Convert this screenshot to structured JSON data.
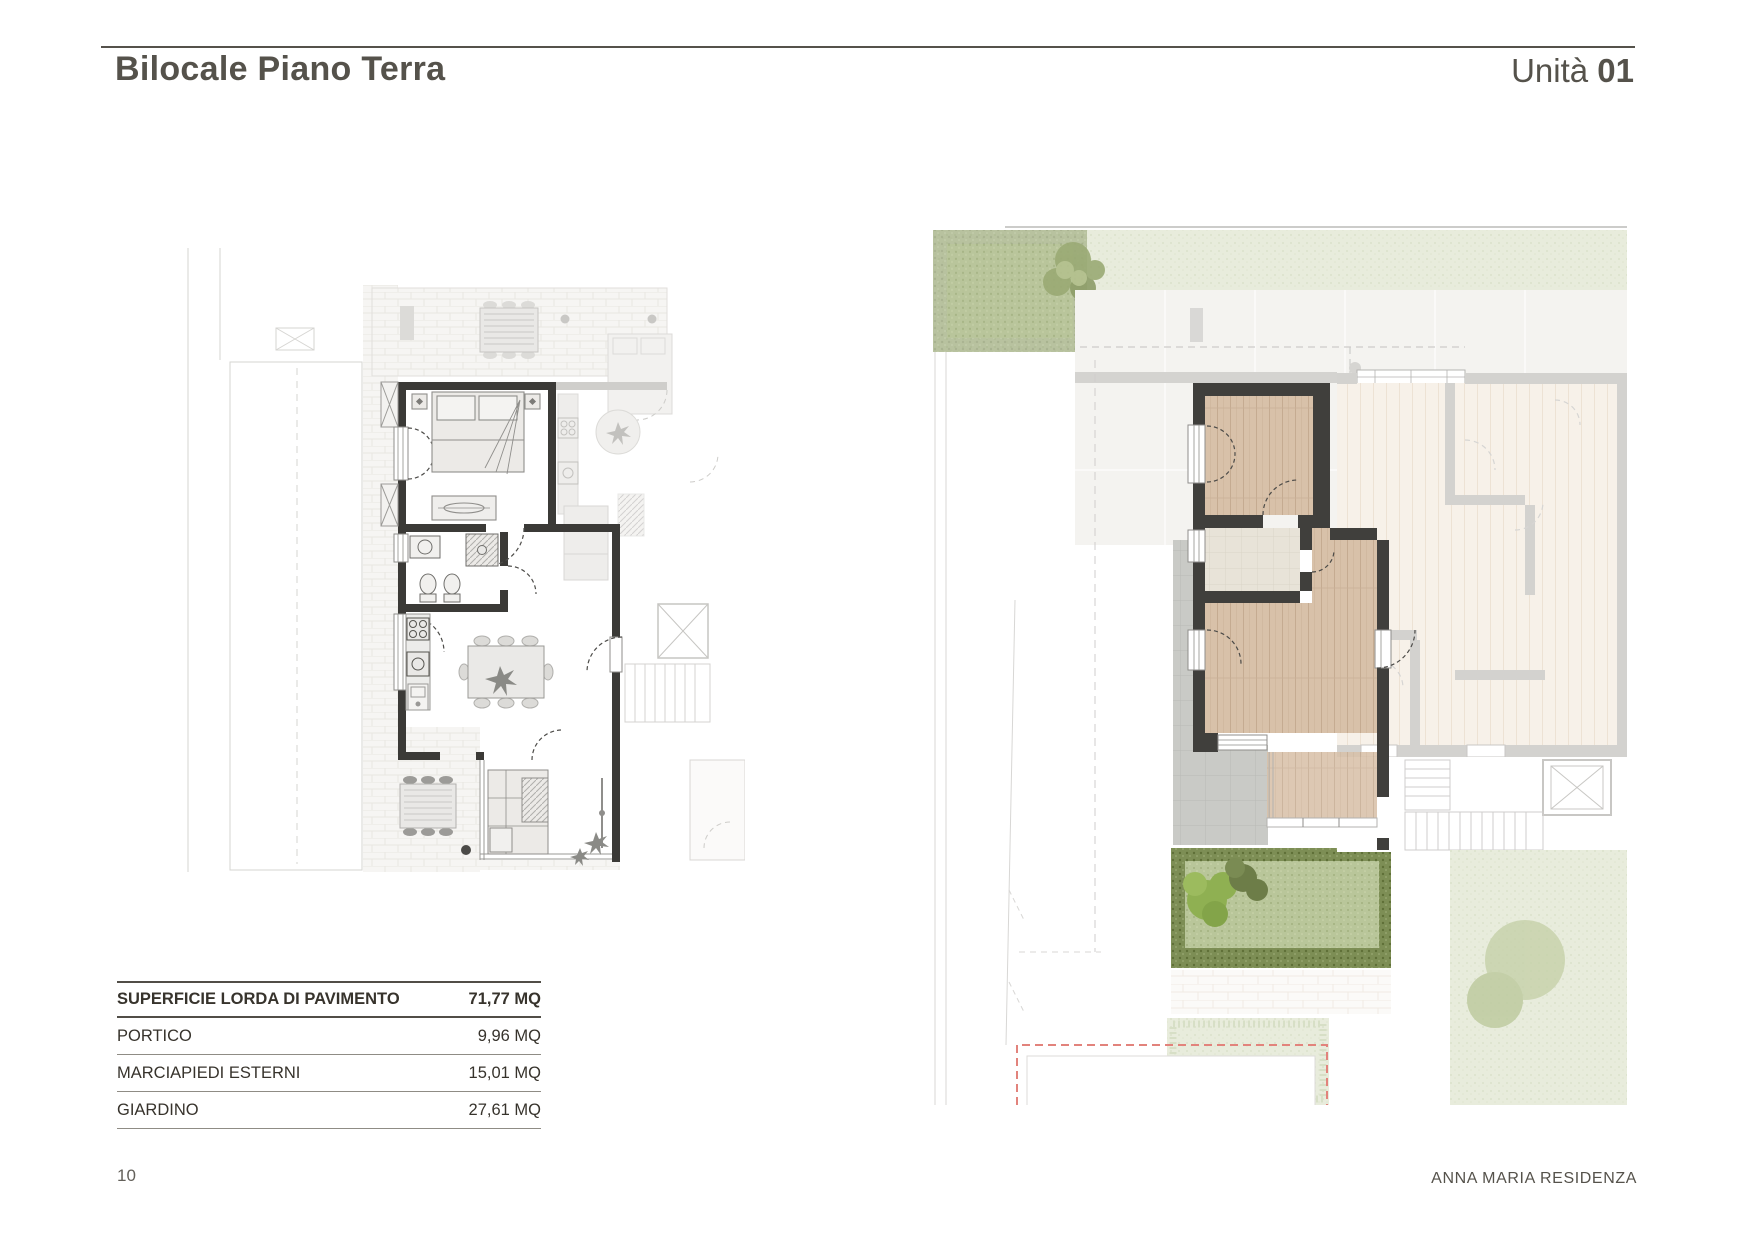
{
  "header": {
    "title": "Bilocale Piano Terra",
    "unit_label": "Unità",
    "unit_number": "01"
  },
  "area_table": {
    "rows": [
      {
        "label": "SUPERFICIE LORDA DI PAVIMENTO",
        "value": "71,77 MQ"
      },
      {
        "label": "PORTICO",
        "value": "9,96 MQ"
      },
      {
        "label": "MARCIAPIEDI ESTERNI",
        "value": "15,01 MQ"
      },
      {
        "label": "GIARDINO",
        "value": "27,61 MQ"
      }
    ]
  },
  "footer": {
    "page_number": "10",
    "project_name": "ANNA MARIA RESIDENZA"
  },
  "colors": {
    "heading": "#55524b",
    "table_rule_dark": "#514e47",
    "table_rule_light": "#8f8c85",
    "plan_wall_dark": "#3b3a37",
    "wood_floor": "#d8c1a9",
    "bath_floor": "#e8e3d8",
    "tile_gray": "#c9cac6",
    "grass_green": "#b9c69a",
    "grass_border": "#7d8e55",
    "pale_green": "#e9ecdf",
    "red_dashed": "#e2837c"
  }
}
